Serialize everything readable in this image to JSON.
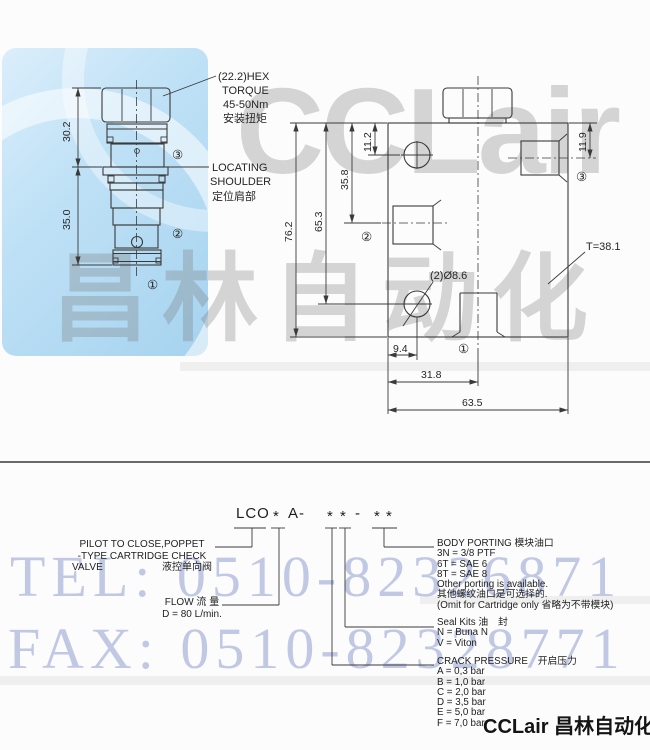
{
  "watermarks": {
    "tel": "TEL: 0510-82326871",
    "fax": "FAX: 0510-82328771",
    "brand_latin": "CCLair",
    "brand_cn": "昌林自动化",
    "footer_brand": "CCLair 昌林自动化",
    "logo_blue": "#a6d3ef",
    "watermark_blue": "#7080c4",
    "watermark_gray": "#787878"
  },
  "left_drawing": {
    "dims": {
      "upper_height": "30.2",
      "lower_height": "35.0"
    },
    "hex_note": {
      "l1": "(22.2)HEX",
      "l2": "TORQUE",
      "l3": "45-50Nm",
      "l4": "安装扭矩"
    },
    "locating_note": {
      "l1": "LOCATING",
      "l2": "SHOULDER",
      "l3": "定位肩部"
    },
    "ports": {
      "p1": "①",
      "p2": "②",
      "p3": "③"
    }
  },
  "right_drawing": {
    "dims": {
      "total_height": "76.2",
      "hole_bottom": "65.3",
      "port2_center": "35.8",
      "hole_top": "11.2",
      "port3_center": "11.9",
      "hole_offset": "9.4",
      "center_offset": "31.8",
      "total_width": "63.5",
      "thickness": "T=38.1",
      "holes": "(2)Ø8.6"
    },
    "ports": {
      "p1": "①",
      "p2": "②",
      "p3": "③"
    }
  },
  "order_code": {
    "parts": [
      "LCO",
      "*",
      "A-",
      "*",
      "*",
      "-",
      "*",
      "*"
    ],
    "pilot": {
      "l1": "PILOT TO CLOSE,POPPET",
      "l2": "-TYPE CARTRIDGE CHECK",
      "l3en": "VALVE",
      "l3cn": "液控单向阀"
    },
    "flow": {
      "l1": "FLOW 流 量",
      "l2": "D = 80 L/min."
    },
    "body_porting": {
      "title": "BODY PORTING 模块油口",
      "items": [
        "3N = 3/8 PTF",
        "6T = SAE 6",
        "8T = SAE 8",
        "Other porting is available.",
        "其他螺纹油口是可选择的.",
        "(Omit for Cartridge only 省略为不带模块)"
      ]
    },
    "seal_kits": {
      "title": "Seal Kits 油　封",
      "items": [
        "N = Buna N",
        "V = Viton"
      ]
    },
    "crack_pressure": {
      "title": "CRACK PRESSURE　开启压力",
      "items": [
        "A = 0,3 bar",
        "B = 1,0 bar",
        "C = 2,0 bar",
        "D = 3,5 bar",
        "E = 5,0 bar",
        "F = 7,0 bar"
      ]
    }
  }
}
